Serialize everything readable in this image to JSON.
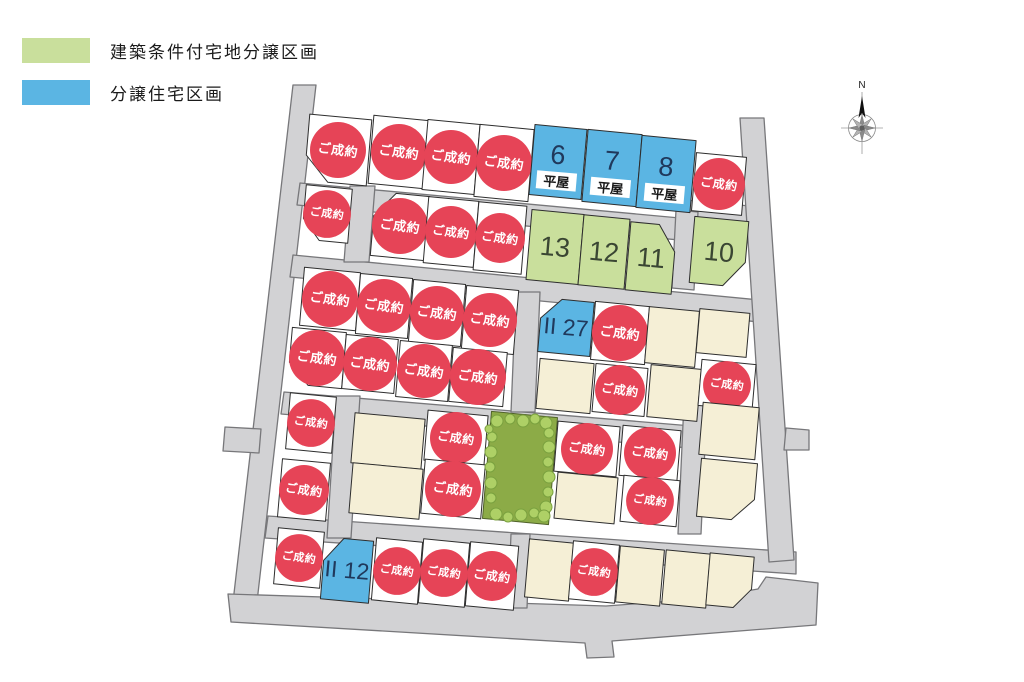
{
  "legend": {
    "items": [
      {
        "label": "建築条件付宅地分譲区画",
        "color": "#c9df9c",
        "meaning": "conditional-land-lot"
      },
      {
        "label": "分譲住宅区画",
        "color": "#5bb5e3",
        "meaning": "built-house-lot"
      }
    ]
  },
  "compass": {
    "north_label": "N"
  },
  "map": {
    "sold_badge_label": "ご成約",
    "single_story_badge_label": "平屋",
    "colors": {
      "road": "#d2d2d4",
      "road_border": "#77777a",
      "lot_border": "#2e2e2e",
      "lot_white": "#ffffff",
      "lot_cream": "#f5efd6",
      "lot_green": "#c9df9c",
      "lot_blue": "#5bb5e3",
      "park_green": "#8cab47",
      "park_border": "#50622a",
      "bush_fill": "#aed066",
      "bush_border": "#7aa13f",
      "sold_red": "#e64457",
      "sold_text": "#ffffff",
      "number_blue_text": "#20395c",
      "number_green_text": "#3a4633",
      "badge_text": "#1a1a1a"
    },
    "roads": [
      [
        [
          293,
          85
        ],
        [
          316,
          85
        ],
        [
          257,
          602
        ],
        [
          233,
          602
        ]
      ],
      [
        [
          300,
          183
        ],
        [
          745,
          224
        ],
        [
          745,
          246
        ],
        [
          297,
          205
        ]
      ],
      [
        [
          686,
          200
        ],
        [
          750,
          206
        ],
        [
          748,
          222
        ],
        [
          684,
          216
        ]
      ],
      [
        [
          676,
          210
        ],
        [
          698,
          212
        ],
        [
          694,
          290
        ],
        [
          672,
          288
        ]
      ],
      [
        [
          293,
          255
        ],
        [
          770,
          301
        ],
        [
          770,
          323
        ],
        [
          290,
          277
        ]
      ],
      [
        [
          284,
          392
        ],
        [
          716,
          428
        ],
        [
          714,
          450
        ],
        [
          281,
          414
        ]
      ],
      [
        [
          268,
          516
        ],
        [
          796,
          552
        ],
        [
          796,
          574
        ],
        [
          265,
          538
        ]
      ],
      [
        [
          228,
          594
        ],
        [
          606,
          606
        ],
        [
          700,
          599
        ],
        [
          758,
          589
        ],
        [
          766,
          577
        ],
        [
          818,
          583
        ],
        [
          816,
          625
        ],
        [
          612,
          641
        ],
        [
          614,
          657
        ],
        [
          587,
          658
        ],
        [
          585,
          643
        ],
        [
          231,
          622
        ]
      ],
      [
        [
          740,
          118
        ],
        [
          764,
          118
        ],
        [
          794,
          560
        ],
        [
          769,
          562
        ]
      ],
      [
        [
          786,
          428
        ],
        [
          809,
          430
        ],
        [
          809,
          450
        ],
        [
          784,
          450
        ]
      ],
      [
        [
          225,
          427
        ],
        [
          261,
          429
        ],
        [
          259,
          453
        ],
        [
          223,
          451
        ]
      ],
      [
        [
          350,
          186
        ],
        [
          375,
          186
        ],
        [
          369,
          262
        ],
        [
          344,
          262
        ]
      ],
      [
        [
          516,
          292
        ],
        [
          540,
          292
        ],
        [
          535,
          412
        ],
        [
          511,
          412
        ]
      ],
      [
        [
          336,
          396
        ],
        [
          360,
          396
        ],
        [
          351,
          538
        ],
        [
          327,
          538
        ]
      ],
      [
        [
          684,
          402
        ],
        [
          707,
          402
        ],
        [
          701,
          534
        ],
        [
          678,
          534
        ]
      ],
      [
        [
          511,
          534
        ],
        [
          530,
          534
        ],
        [
          527,
          608
        ],
        [
          508,
          608
        ]
      ]
    ],
    "lots": [
      {
        "type": "sold",
        "x": 338,
        "y": 150,
        "w": 62,
        "h": 66,
        "cut": "BL"
      },
      {
        "type": "sold",
        "x": 399,
        "y": 152,
        "w": 56,
        "h": 68
      },
      {
        "type": "sold",
        "x": 451,
        "y": 157,
        "w": 52,
        "h": 70
      },
      {
        "type": "sold",
        "x": 504,
        "y": 163,
        "w": 54,
        "h": 72
      },
      {
        "type": "blue",
        "label": "6",
        "badge": true,
        "x": 558,
        "y": 162,
        "w": 52,
        "h": 70
      },
      {
        "type": "blue",
        "label": "7",
        "badge": true,
        "x": 612,
        "y": 168,
        "w": 54,
        "h": 72
      },
      {
        "type": "blue",
        "label": "8",
        "badge": true,
        "x": 666,
        "y": 174,
        "w": 54,
        "h": 72
      },
      {
        "type": "sold",
        "x": 719,
        "y": 184,
        "w": 50,
        "h": 58
      },
      {
        "type": "sold",
        "x": 327,
        "y": 214,
        "w": 46,
        "h": 54,
        "cut": "BL"
      },
      {
        "type": "sold",
        "x": 400,
        "y": 226,
        "w": 54,
        "h": 64,
        "cut": "TL"
      },
      {
        "type": "sold",
        "x": 451,
        "y": 232,
        "w": 50,
        "h": 66
      },
      {
        "type": "sold",
        "x": 500,
        "y": 238,
        "w": 48,
        "h": 68
      },
      {
        "type": "green",
        "label": "13",
        "x": 555,
        "y": 247,
        "w": 52,
        "h": 70
      },
      {
        "type": "green",
        "label": "12",
        "x": 604,
        "y": 252,
        "w": 46,
        "h": 70
      },
      {
        "type": "green",
        "label": "11",
        "x": 651,
        "y": 258,
        "w": 46,
        "h": 68,
        "cut": "TR"
      },
      {
        "type": "green",
        "label": "10",
        "x": 719,
        "y": 252,
        "w": 54,
        "h": 66,
        "cut": "BR"
      },
      {
        "type": "sold",
        "x": 330,
        "y": 299,
        "w": 56,
        "h": 58
      },
      {
        "type": "sold",
        "x": 384,
        "y": 306,
        "w": 52,
        "h": 60
      },
      {
        "type": "sold",
        "x": 437,
        "y": 313,
        "w": 52,
        "h": 62
      },
      {
        "type": "sold",
        "x": 490,
        "y": 320,
        "w": 52,
        "h": 64
      },
      {
        "type": "sold",
        "x": 317,
        "y": 358,
        "w": 54,
        "h": 56,
        "cut": "BL"
      },
      {
        "type": "sold",
        "x": 370,
        "y": 364,
        "w": 52,
        "h": 54
      },
      {
        "type": "sold",
        "x": 424,
        "y": 371,
        "w": 52,
        "h": 56
      },
      {
        "type": "sold",
        "x": 478,
        "y": 377,
        "w": 54,
        "h": 54
      },
      {
        "type": "blue",
        "label": "II 27",
        "x": 566,
        "y": 327,
        "w": 52,
        "h": 54,
        "cut": "TL"
      },
      {
        "type": "sold",
        "x": 620,
        "y": 333,
        "w": 54,
        "h": 58
      },
      {
        "type": "cream",
        "x": 672,
        "y": 337,
        "w": 50,
        "h": 56
      },
      {
        "type": "cream",
        "x": 723,
        "y": 333,
        "w": 50,
        "h": 44
      },
      {
        "type": "cream",
        "x": 565,
        "y": 386,
        "w": 54,
        "h": 50
      },
      {
        "type": "sold",
        "x": 620,
        "y": 390,
        "w": 52,
        "h": 48
      },
      {
        "type": "cream",
        "x": 674,
        "y": 393,
        "w": 50,
        "h": 52
      },
      {
        "type": "sold",
        "x": 727,
        "y": 385,
        "w": 54,
        "h": 46
      },
      {
        "type": "sold",
        "x": 311,
        "y": 423,
        "w": 46,
        "h": 56
      },
      {
        "type": "sold",
        "x": 304,
        "y": 490,
        "w": 48,
        "h": 58
      },
      {
        "type": "cream",
        "x": 388,
        "y": 441,
        "w": 70,
        "h": 50
      },
      {
        "type": "cream",
        "x": 386,
        "y": 491,
        "w": 70,
        "h": 50
      },
      {
        "type": "sold",
        "x": 456,
        "y": 438,
        "w": 60,
        "h": 50
      },
      {
        "type": "sold",
        "x": 453,
        "y": 489,
        "w": 60,
        "h": 54
      },
      {
        "type": "park",
        "x": 520,
        "y": 468,
        "w": 66,
        "h": 107
      },
      {
        "type": "sold",
        "x": 587,
        "y": 449,
        "w": 62,
        "h": 50
      },
      {
        "type": "sold",
        "x": 650,
        "y": 453,
        "w": 58,
        "h": 50
      },
      {
        "type": "cream",
        "x": 586,
        "y": 498,
        "w": 60,
        "h": 46
      },
      {
        "type": "sold",
        "x": 650,
        "y": 501,
        "w": 56,
        "h": 46
      },
      {
        "type": "cream",
        "x": 729,
        "y": 431,
        "w": 56,
        "h": 52
      },
      {
        "type": "cream",
        "x": 727,
        "y": 490,
        "w": 56,
        "h": 58,
        "cut": "BR"
      },
      {
        "type": "sold",
        "x": 299,
        "y": 558,
        "w": 46,
        "h": 56
      },
      {
        "type": "blue",
        "label": "II 12",
        "x": 347,
        "y": 570,
        "w": 48,
        "h": 62,
        "cut": "TL"
      },
      {
        "type": "sold",
        "x": 397,
        "y": 571,
        "w": 46,
        "h": 62
      },
      {
        "type": "sold",
        "x": 444,
        "y": 573,
        "w": 46,
        "h": 64
      },
      {
        "type": "sold",
        "x": 492,
        "y": 576,
        "w": 48,
        "h": 64
      },
      {
        "type": "cream",
        "x": 549,
        "y": 570,
        "w": 44,
        "h": 58
      },
      {
        "type": "sold",
        "x": 594,
        "y": 572,
        "w": 46,
        "h": 58
      },
      {
        "type": "cream",
        "x": 640,
        "y": 576,
        "w": 44,
        "h": 56
      },
      {
        "type": "cream",
        "x": 686,
        "y": 579,
        "w": 44,
        "h": 54
      },
      {
        "type": "cream",
        "x": 730,
        "y": 581,
        "w": 44,
        "h": 52,
        "cut": "BR"
      }
    ],
    "park_bushes": [
      [
        497,
        421,
        6
      ],
      [
        510,
        419,
        5
      ],
      [
        523,
        421,
        6
      ],
      [
        535,
        419,
        5
      ],
      [
        546,
        423,
        6
      ],
      [
        549,
        433,
        5
      ],
      [
        492,
        437,
        5
      ],
      [
        549,
        447,
        6
      ],
      [
        491,
        452,
        6
      ],
      [
        548,
        462,
        5
      ],
      [
        490,
        467,
        5
      ],
      [
        549,
        477,
        6
      ],
      [
        491,
        483,
        6
      ],
      [
        548,
        492,
        5
      ],
      [
        491,
        498,
        5
      ],
      [
        546,
        507,
        6
      ],
      [
        496,
        514,
        6
      ],
      [
        508,
        517,
        5
      ],
      [
        521,
        515,
        6
      ],
      [
        534,
        513,
        5
      ],
      [
        544,
        516,
        6
      ],
      [
        489,
        429,
        4
      ]
    ]
  }
}
